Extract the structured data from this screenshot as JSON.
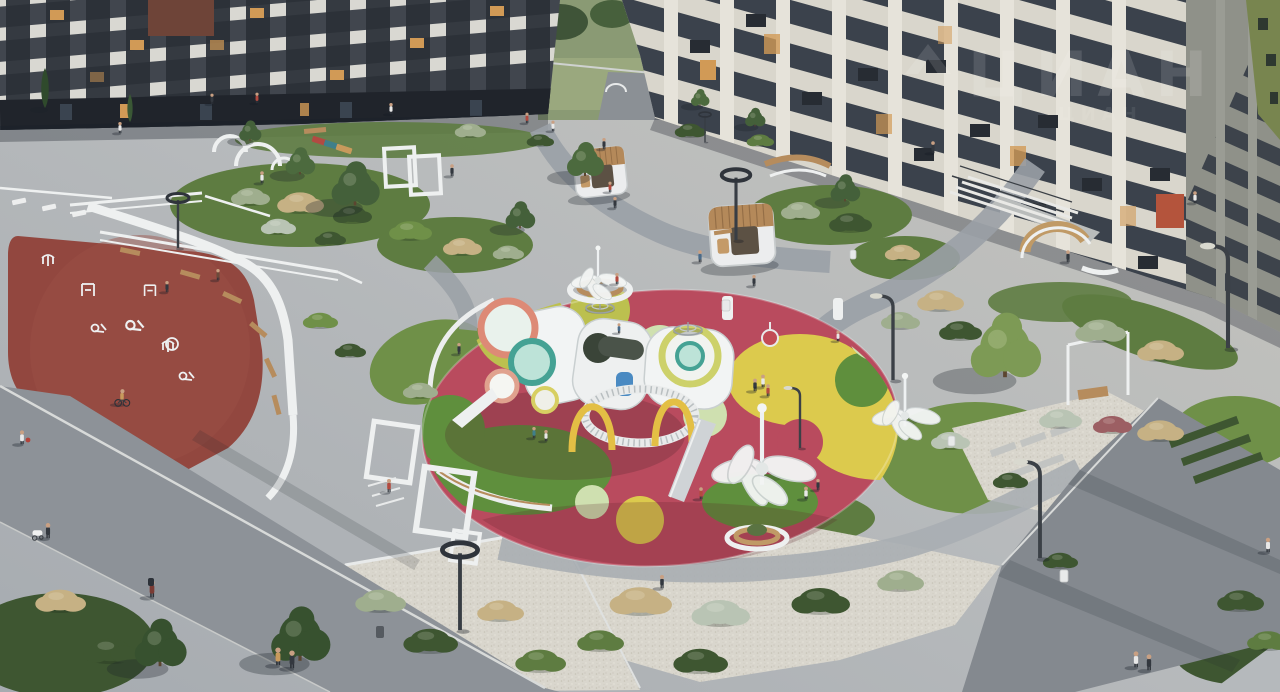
{
  "meta": {
    "alt": "3D render of a residential courtyard: apartment buildings around a landscaped yard with a colorful oval playground, white play structures, dandelion sculptures, a red outdoor fitness track with white exercise machines, gravel gardens, wooden seating pods, pergolas and pedestrians in evening light"
  },
  "watermark": {
    "text": "ЦИАН",
    "opacity": "0.12"
  },
  "palette": {
    "paving": "#b5b9bc",
    "pavingWarm": "#c6c4bb",
    "asphalt": "#8d9298",
    "asphaltDark": "#84898f",
    "gravel": "#d9d6cd",
    "lawn": "#5e7c41",
    "lawnBright": "#6f9048",
    "bushDark": "#3e5631",
    "bushSage": "#9fae8e",
    "bushTan": "#c6b184",
    "bushSilver": "#b9c4b4",
    "bushRed": "#9c5f63",
    "trackRed": "#92473f",
    "pgRed": "#b94b5e",
    "pgChartreuse": "#bcc04f",
    "pgYellow": "#dcca4d",
    "pgMint": "#cfe0b0",
    "pgGreen": "#5f8f3d",
    "pgOlive": "#97994b",
    "bldLeftDark": "#41464e",
    "bandWhite": "#d9d8d2",
    "windowDark": "#23272e",
    "litWindow": "#d19a56",
    "litRed": "#b4543c",
    "bldRightCream": "#d9d6cc",
    "bldRightRow": "#3b424c",
    "bldSide": "#8f9189",
    "greenFacade": "#78854f",
    "structureWhite": "#eef0f0",
    "wood": "#b68c5d",
    "treeGreen": "#44603a",
    "treeLight": "#7d9a55",
    "fieldGreen": "#8a9a74"
  }
}
